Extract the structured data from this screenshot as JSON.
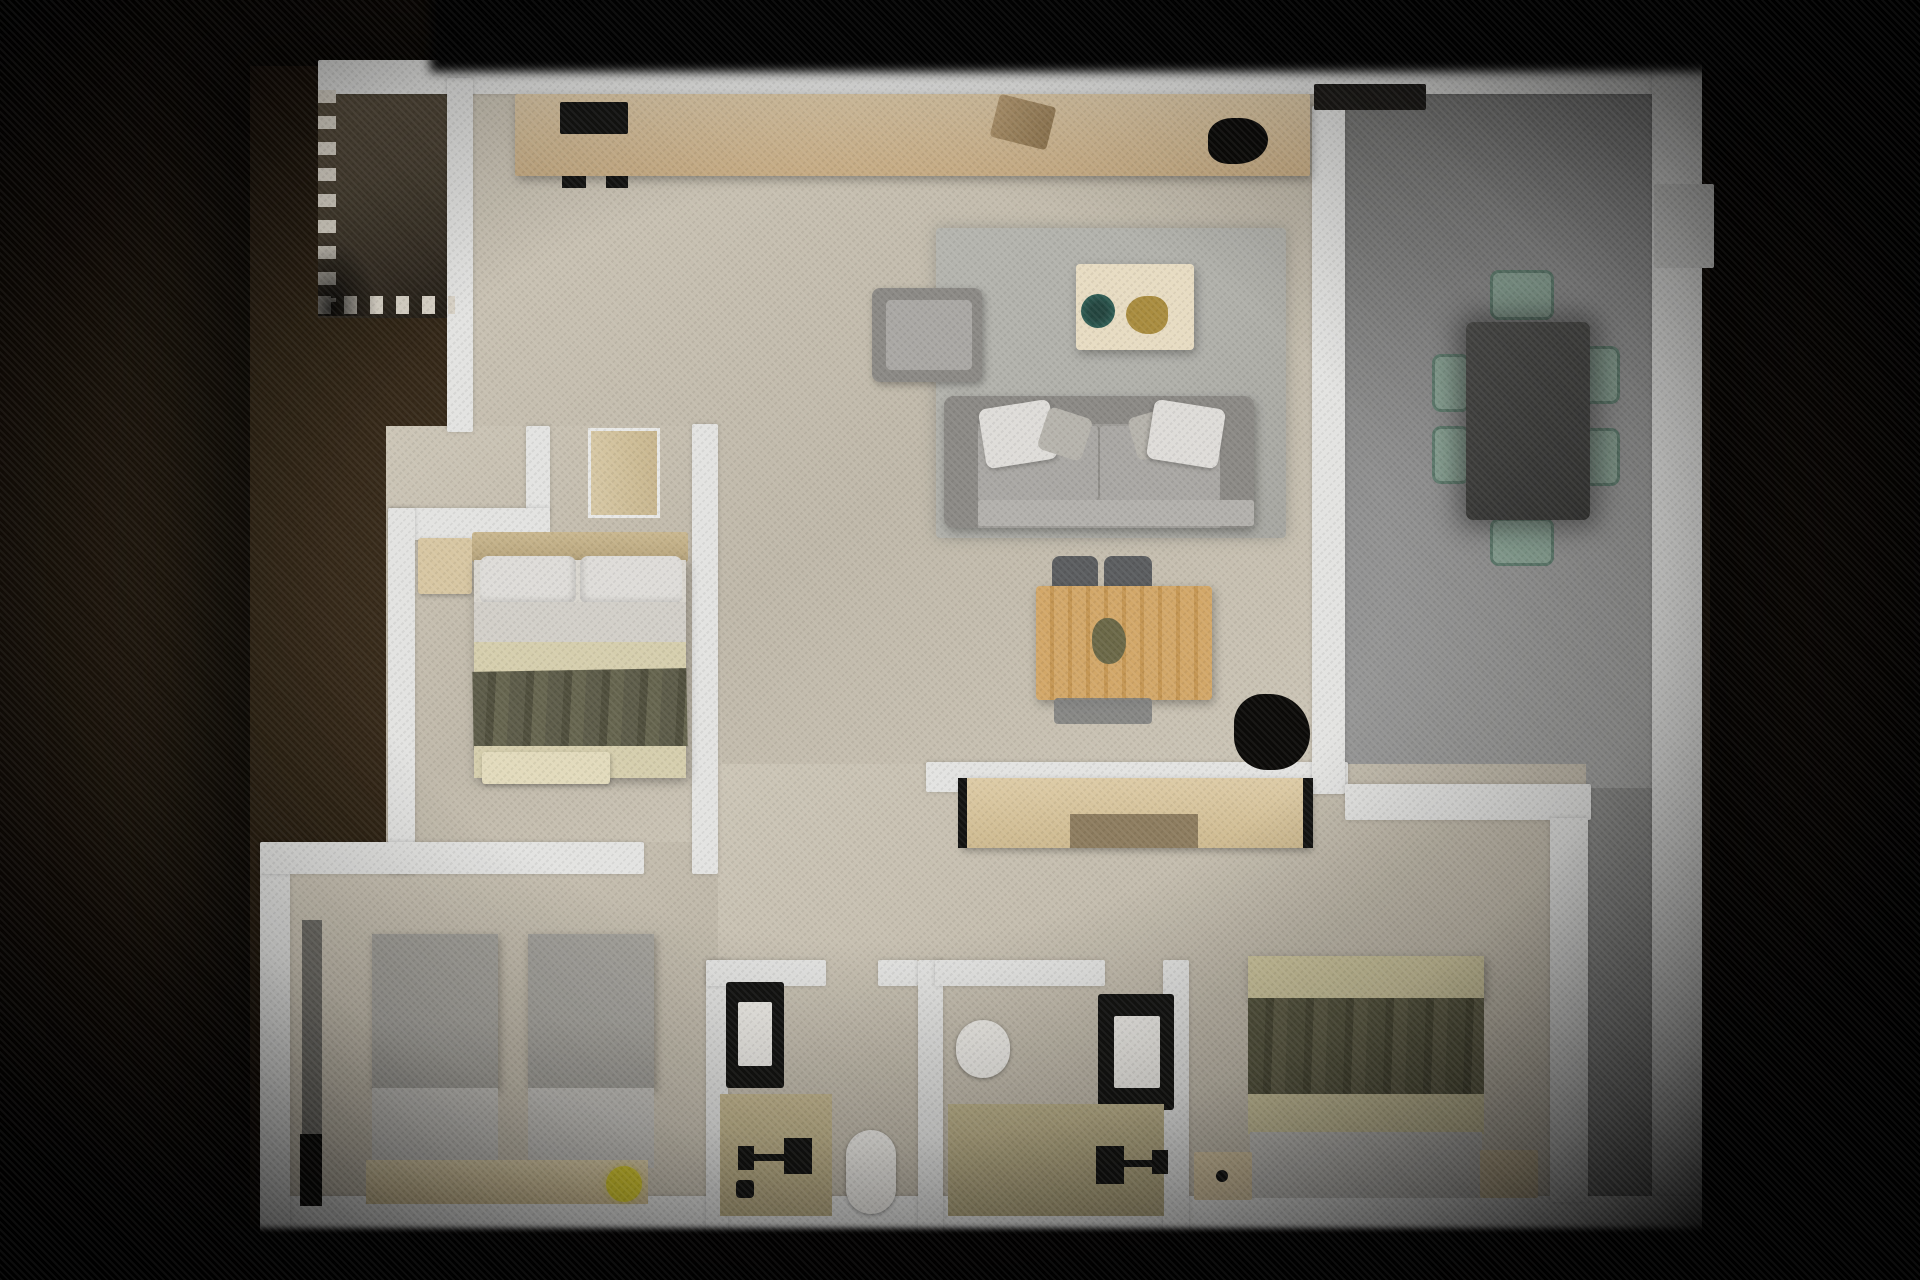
{
  "scene": {
    "title": "Apartment floor plan - photorealistic 3D top-down render",
    "view": "top-down",
    "backdrop": "dark brown vignette, black bands top and bottom"
  },
  "colors": {
    "wall": "#e3e3e1",
    "floor": "#ccc5b6",
    "floor-dark": "#bfb8a9",
    "dining": "#909090",
    "dining-dark": "#737371",
    "terrace": "#8b8b89",
    "balcony": "#4a4133",
    "dash": "#d8d2c6",
    "counter": "#dcc8a6",
    "counter-dark": "#c7ac84",
    "appliance": "#141412",
    "wood": "#d7c6a2",
    "wood-dark": "#8d7c5f",
    "btable": "#d2a768",
    "chair-gray": "#5b5d5f",
    "sofa": "#9d9b97",
    "sofa-dark": "#8b8985",
    "cushion": "#a9a7a3",
    "pillow": "#dedcd8",
    "rug": "#afafa9",
    "coffee-table": "#e7dcc2",
    "teal": "#2f5d54",
    "gold": "#a98c3f",
    "dining-table": "#424240",
    "sage": "#8aa395",
    "sage-dark": "#627f71",
    "sheet": "#d9d6cf",
    "cream": "#d5cead",
    "olive": "#5d5c49",
    "olive2": "#56553f",
    "twin-blanket": "#a8a6a0",
    "twin-sheet": "#c2c0bb",
    "khaki": "#cdc59d",
    "foot-gray": "#c5c3be",
    "porcelain": "#edebe6",
    "vanity": "#c6b991",
    "vanity2": "#bcb18a",
    "yellow": "#d6c92f",
    "ink": "#0c0b09",
    "gray-strip": "#6e6c66"
  },
  "rooms": [
    {
      "id": "balcony",
      "label": "Balcony",
      "floor": "brown tile",
      "features": [
        "dashed railing left",
        "dashed railing bottom"
      ]
    },
    {
      "id": "kitchen",
      "label": "Kitchen",
      "furniture": [
        "counter run",
        "black cooktop",
        "sink block",
        "dark counter plant"
      ]
    },
    {
      "id": "living-room",
      "label": "Living room",
      "furniture": [
        "gray sofa with pillows",
        "gray armchair",
        "gray rug",
        "cream coffee table",
        "teal dish",
        "gold decor",
        "wood breakfast table",
        "dark chairs",
        "black floor plant"
      ]
    },
    {
      "id": "dining-room",
      "label": "Dining room",
      "floor": "gray",
      "furniture": [
        "charcoal dining table",
        "six sage chairs"
      ],
      "features": [
        "window tab on right wall"
      ]
    },
    {
      "id": "master-bedroom",
      "label": "Bedroom 1",
      "furniture": [
        "double bed olive throw",
        "wood headboard",
        "nightstand",
        "foot bench",
        "wardrobe"
      ]
    },
    {
      "id": "twin-bedroom",
      "label": "Bedroom 2",
      "furniture": [
        "twin bed left",
        "twin bed right",
        "headboard shelf",
        "yellow stool",
        "tall wardrobe strip"
      ]
    },
    {
      "id": "bedroom-3",
      "label": "Bedroom 3",
      "furniture": [
        "double bed olive throw",
        "sideboard wardrobe",
        "two nightstands"
      ]
    },
    {
      "id": "bathroom-1",
      "label": "Bathroom 1",
      "furniture": [
        "dark framed shower",
        "vanity with black faucet",
        "toilet"
      ]
    },
    {
      "id": "bathroom-2",
      "label": "Bathroom 2",
      "furniture": [
        "dark framed shower",
        "vanity with black faucet",
        "toilet"
      ]
    },
    {
      "id": "terrace-strip",
      "label": "Side terrace",
      "floor": "gray"
    }
  ]
}
